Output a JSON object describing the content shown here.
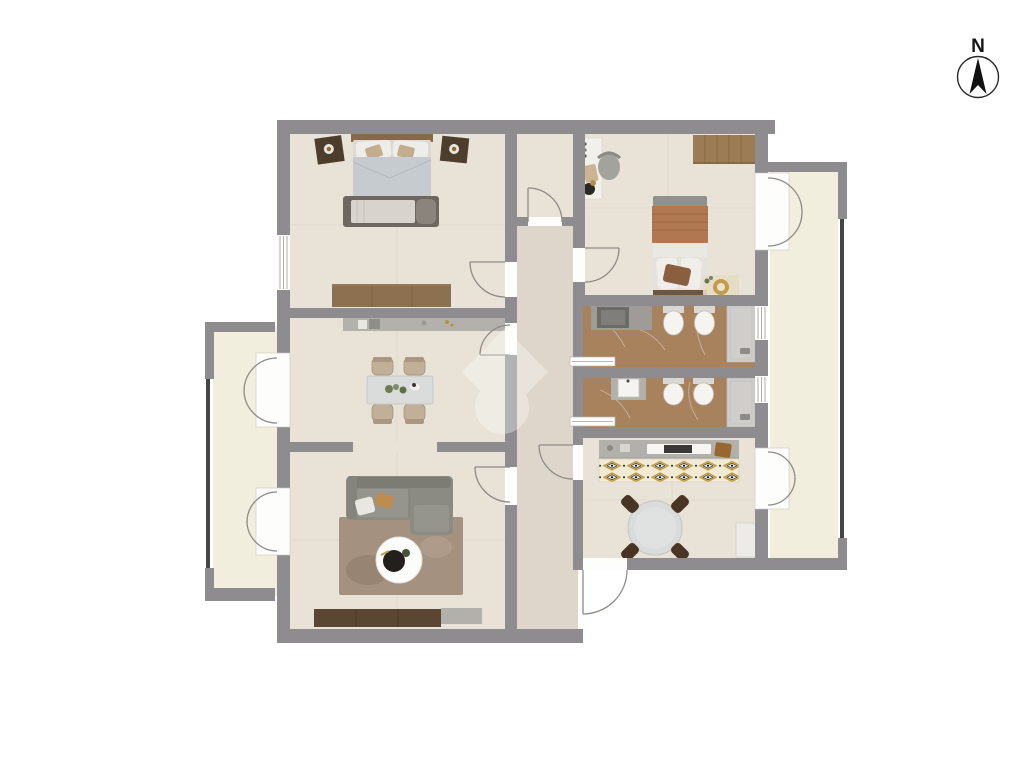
{
  "compass": {
    "label": "N"
  },
  "palette": {
    "wall": "#8f8c90",
    "floor": "#e8e3d6",
    "hallFloor": "#ded6ca",
    "balconyFloor": "#f2eedd",
    "bathFloor": "#a8815d",
    "shower": "#d0cecb",
    "wood": "#9c7c54",
    "woodDark": "#5b4733",
    "counter": "#b2b0ab",
    "sofa": "#8b8b83",
    "rugLiving": "#a5917f",
    "rugKitchen": "#f0ead6",
    "gold": "#c09a3e",
    "duvet": "#c6cbd0",
    "terracotta": "#b07850",
    "fixture": "#f5f4f1",
    "tableTop": "#dbdedd",
    "chairTan": "#c2af97",
    "chairDark": "#4a3423",
    "railing": "#454545",
    "line": "#8e8b88",
    "background": "#ffffff",
    "watermark": "#ffffff"
  },
  "rooms": [
    {
      "name": "bedroom-1",
      "furniture": [
        "double-bed",
        "nightstand-left",
        "nightstand-right",
        "foot-bench",
        "dresser"
      ]
    },
    {
      "name": "walk-in-closet",
      "furniture": []
    },
    {
      "name": "bedroom-2",
      "furniture": [
        "single-bed",
        "desk",
        "desk-chair",
        "wardrobe",
        "rug-with-plant"
      ]
    },
    {
      "name": "bathroom-1",
      "furniture": [
        "vanity",
        "toilet",
        "bidet",
        "shower"
      ]
    },
    {
      "name": "bathroom-2",
      "furniture": [
        "sink",
        "toilet",
        "bidet",
        "shower"
      ]
    },
    {
      "name": "kitchen",
      "furniture": [
        "counter-with-hob",
        "patterned-rug",
        "round-table",
        "four-chairs",
        "cabinet"
      ]
    },
    {
      "name": "dining-room",
      "furniture": [
        "sideboard",
        "dining-table",
        "four-chairs"
      ]
    },
    {
      "name": "living-room",
      "furniture": [
        "sofa",
        "rug",
        "coffee-table",
        "tv-console",
        "gray-unit"
      ]
    },
    {
      "name": "hallway",
      "furniture": []
    },
    {
      "name": "balcony-west",
      "furniture": []
    },
    {
      "name": "balcony-east",
      "furniture": []
    }
  ],
  "watermark": {
    "present": true,
    "description": "faint white diamond and circle logo overlay"
  }
}
